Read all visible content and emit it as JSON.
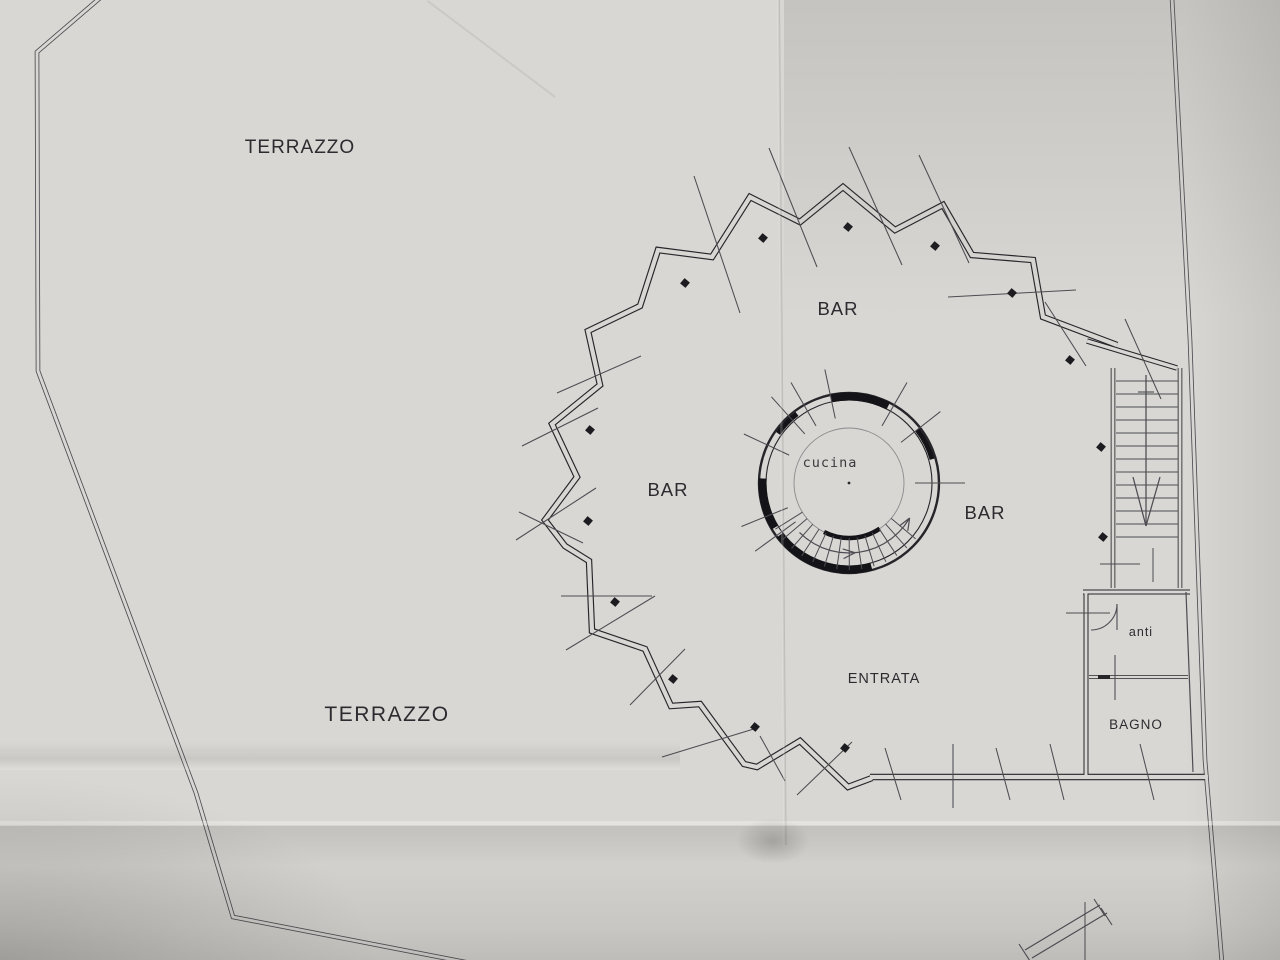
{
  "plan": {
    "labels": {
      "terrazzo_top": "TERRAZZO",
      "terrazzo_bottom": "TERRAZZO",
      "bar_top": "BAR",
      "bar_left": "BAR",
      "bar_right": "BAR",
      "entrata": "ENTRATA",
      "cucina": "cucina",
      "anti": "anti",
      "bagno": "BAGNO"
    },
    "rooms": [
      "TERRAZZO",
      "BAR",
      "ENTRATA",
      "cucina",
      "anti",
      "BAGNO"
    ],
    "symbols": [
      "spiral-staircase",
      "straight-staircase",
      "door-swing",
      "window-ticks",
      "column-posts"
    ],
    "colors": {
      "paper": "#d9d7d3",
      "paper_shadow": "#c7c5c1",
      "wall_ink": "#26262a",
      "thin_ink": "#4c4c52",
      "text_ink": "#2c2c30"
    }
  }
}
